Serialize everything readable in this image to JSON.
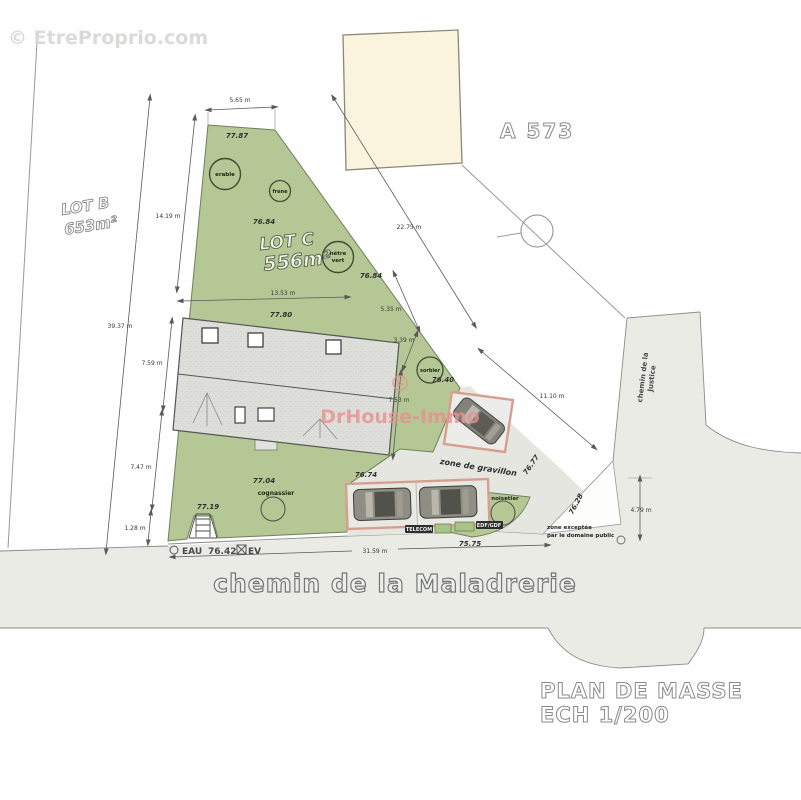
{
  "watermarks": {
    "etreproprio": "© EtreProprio.com",
    "drhouse": "DrHouse-Immo",
    "copyright_symbol": "©"
  },
  "parcels": {
    "lot_b": {
      "name": "LOT B",
      "area": "653m²"
    },
    "lot_c": {
      "name": "LOT C",
      "area": "556m²"
    },
    "neighbor": "A 573"
  },
  "streets": {
    "south": "chemin de la Maladrerie",
    "east_line1": "chemin de la",
    "east_line2": "Justice"
  },
  "title": {
    "line1": "PLAN DE MASSE",
    "line2": "ECH 1/200"
  },
  "trees": [
    {
      "label": "erable"
    },
    {
      "label": "frene"
    },
    {
      "label": "hêtre",
      "label2": "vert"
    },
    {
      "label": "sorbier"
    },
    {
      "label": "cognassier"
    },
    {
      "label": "noisetier"
    }
  ],
  "elevations": [
    "77.87",
    "76.84",
    "76.84",
    "77.80",
    "76.40",
    "76.77",
    "76.74",
    "77.04",
    "77.19",
    "75.75",
    "76.28"
  ],
  "dimensions": [
    "5.65 m",
    "14.19 m",
    "39.37 m",
    "7.59 m",
    "7.47 m",
    "1.28 m",
    "13.53 m",
    "5.35 m",
    "3.39 m",
    "7.53 m",
    "22.75 m",
    "11.10 m",
    "31.59 m",
    "4.79 m"
  ],
  "utilities": {
    "eau": "EAU",
    "eau_value": "76.42",
    "ev": "EV",
    "telecom": "TELECOM",
    "edf": "EDF/GDF"
  },
  "zones": {
    "gravel": "zone de gravillon",
    "public_line1": "zone exceptée",
    "public_line2": "par le domaine public"
  },
  "colors": {
    "garden_green": "#b4c794",
    "road_gray": "#eaebe5",
    "gravel_gray": "#e6e6e1",
    "beige_building": "#faf4df",
    "parking_border_pink": "#d79f8e",
    "watermark_pink": "#ea8f8f"
  }
}
